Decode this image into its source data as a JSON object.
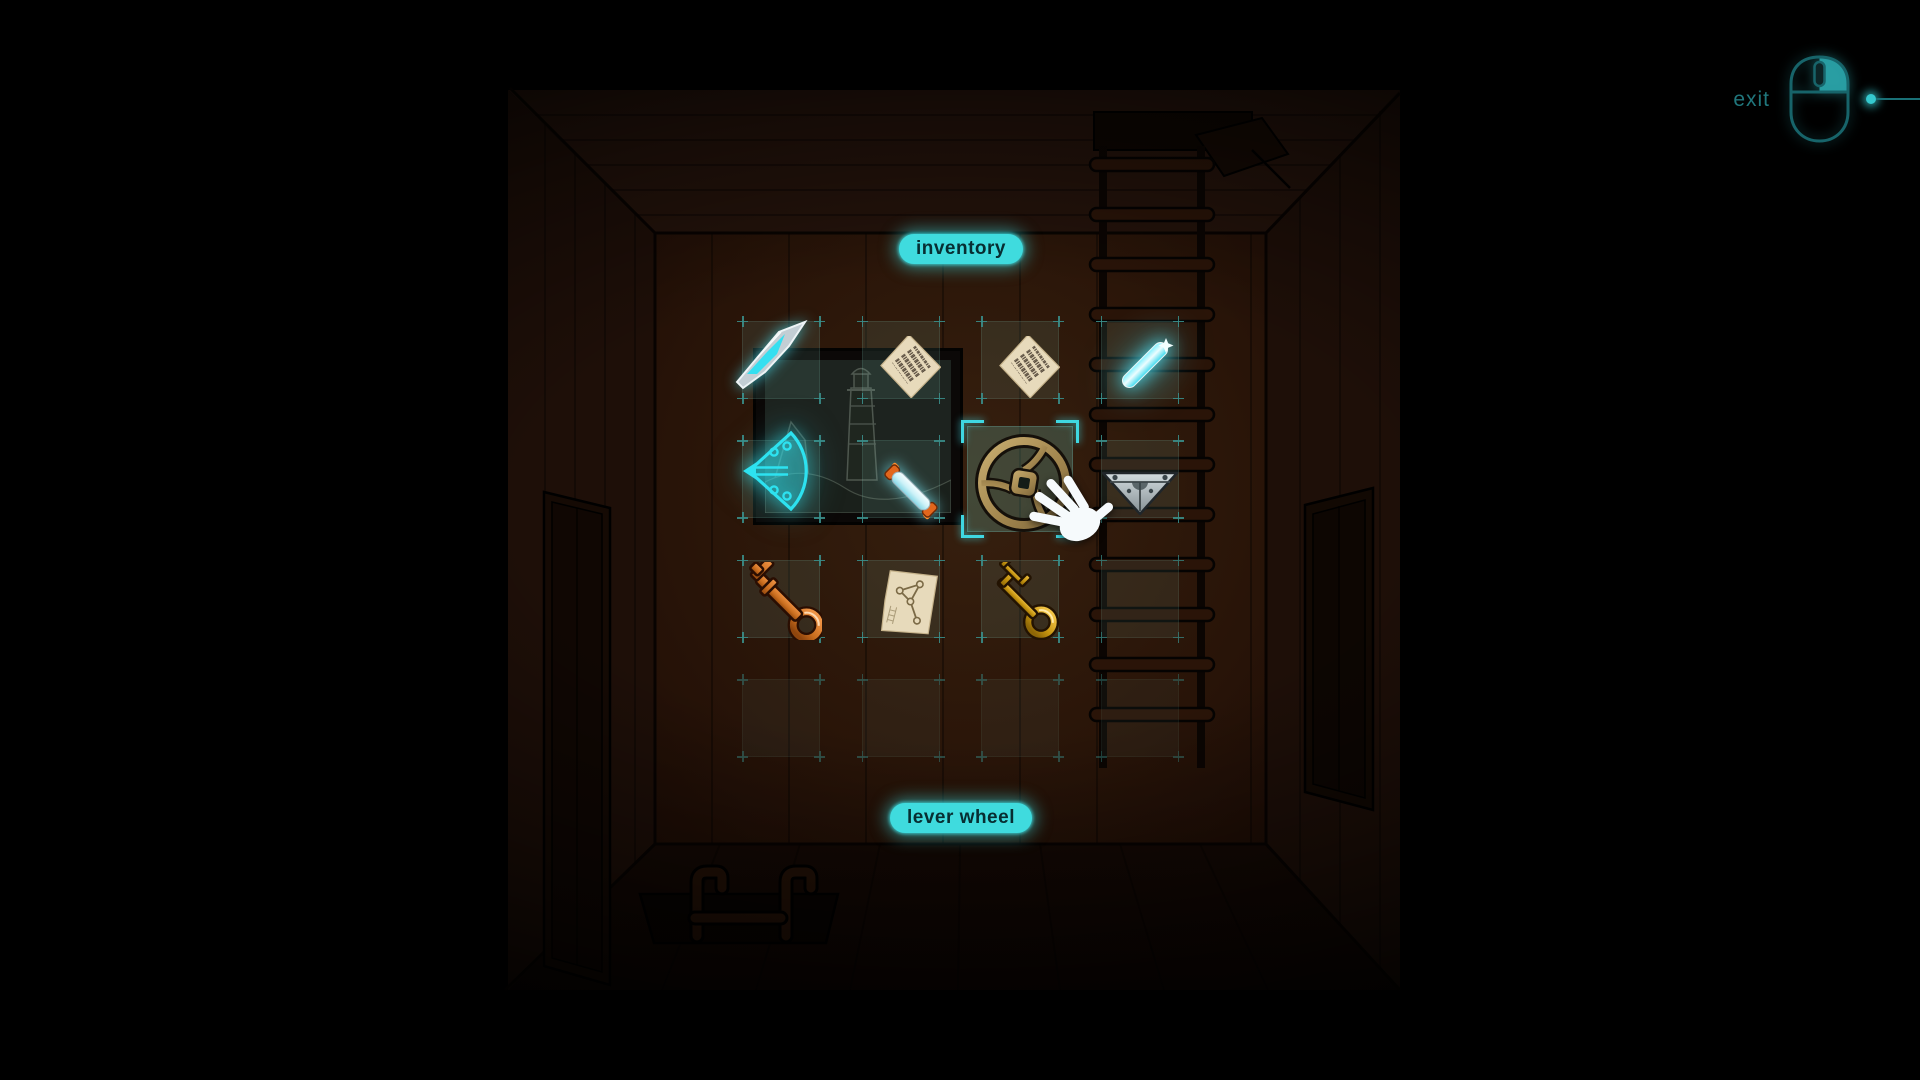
{
  "ui": {
    "inventory_label": "inventory",
    "selected_item_label": "lever wheel",
    "exit_label": "exit"
  },
  "inventory": {
    "rows": 4,
    "cols": 4,
    "selected_slot": {
      "row": 2,
      "col": 3
    },
    "items": [
      {
        "id": "glass-shard",
        "name": "glass shard",
        "row": 1,
        "col": 1,
        "selected": false
      },
      {
        "id": "code-paper-1",
        "name": "paper with code marks",
        "row": 1,
        "col": 2,
        "selected": false
      },
      {
        "id": "code-paper-2",
        "name": "paper with code marks",
        "row": 1,
        "col": 3,
        "selected": false
      },
      {
        "id": "glow-stick",
        "name": "glowing stick",
        "row": 1,
        "col": 4,
        "selected": false
      },
      {
        "id": "glowing-fan",
        "name": "glowing fan shell",
        "row": 2,
        "col": 1,
        "selected": false
      },
      {
        "id": "fluorescent-tube",
        "name": "fluorescent tube",
        "row": 2,
        "col": 2,
        "selected": false
      },
      {
        "id": "lever-wheel",
        "name": "lever wheel",
        "row": 2,
        "col": 3,
        "selected": true
      },
      {
        "id": "metal-bracket",
        "name": "metal bracket",
        "row": 2,
        "col": 4,
        "selected": false
      },
      {
        "id": "copper-key",
        "name": "copper key",
        "row": 3,
        "col": 1,
        "selected": false
      },
      {
        "id": "map-paper",
        "name": "map paper",
        "row": 3,
        "col": 2,
        "selected": false
      },
      {
        "id": "gold-key",
        "name": "gold key",
        "row": 3,
        "col": 3,
        "selected": false
      }
    ]
  },
  "cursor": {
    "type": "hand-cursor"
  },
  "colors": {
    "accent_cyan": "#3fdbde",
    "glow_cyan": "#2de2f0",
    "label_text": "#072e32",
    "exit_text": "#20767c",
    "brass": "#ad915c",
    "copper": "#c9701f",
    "gold": "#cf9c1d",
    "paper": "#e7dabb",
    "wall_brown": "#2e1809"
  },
  "scene": {
    "elements": [
      "ladder",
      "ceiling-hatch",
      "picture-frame-lighthouse",
      "left-door",
      "right-door",
      "sink-basin"
    ]
  }
}
